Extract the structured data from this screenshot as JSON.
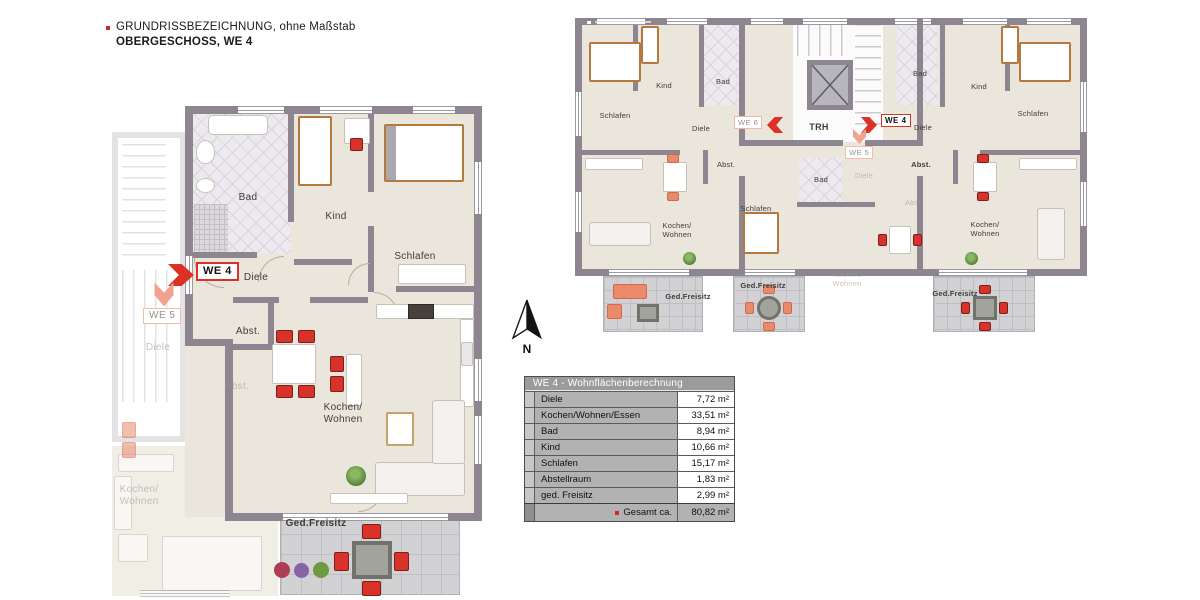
{
  "legend": {
    "line1": "GRUNDRISSBEZEICHNUNG, ohne Maßstab",
    "line2": "OBERGESCHOSS, WE 4"
  },
  "compass": {
    "north_label": "N"
  },
  "detail_plan": {
    "badges": {
      "we4": "WE 4",
      "we5": "WE 5"
    },
    "rooms": {
      "bad": "Bad",
      "kind": "Kind",
      "schlafen": "Schlafen",
      "diele": "Diele",
      "abst_top": "Abst.",
      "abst_bottom": "Abst.",
      "kochen_wohnen": "Kochen/\nWohnen",
      "ged_freisitz": "Ged.Freisitz"
    },
    "neighbor": {
      "diele": "Diele",
      "kochen_wohnen": "Kochen/\nWohnen"
    }
  },
  "overview_plan": {
    "stairwell_label": "TRH",
    "badges": {
      "we6": "WE 6",
      "we4": "WE 4",
      "we5": "WE 5"
    },
    "we6": {
      "schlafen": "Schlafen",
      "kind": "Kind",
      "bad": "Bad",
      "diele": "Diele",
      "abst": "Abst.",
      "kochen_wohnen": "Kochen/\nWohnen",
      "ged_freisitz": "Ged.Freisitz"
    },
    "we5": {
      "bad": "Bad",
      "diele": "Diele",
      "schlafen": "Schlafen",
      "abst": "Abst.",
      "kochen_wohnen": "Kochen/\nWohnen",
      "ged_freisitz": "Ged.Freisitz"
    },
    "we4": {
      "bad": "Bad",
      "kind": "Kind",
      "schlafen": "Schlafen",
      "diele": "Diele",
      "abst": "Abst.",
      "kochen_wohnen": "Kochen/\nWohnen",
      "ged_freisitz": "Ged.Freisitz"
    }
  },
  "area_table": {
    "title": "WE 4 - Wohnflächenberechnung",
    "rows": [
      {
        "label": "Diele",
        "value": "7,72 m²"
      },
      {
        "label": "Kochen/Wohnen/Essen",
        "value": "33,51 m²"
      },
      {
        "label": "Bad",
        "value": "8,94 m²"
      },
      {
        "label": "Kind",
        "value": "10,66 m²"
      },
      {
        "label": "Schlafen",
        "value": "15,17 m²"
      },
      {
        "label": "Abstellraum",
        "value": "1,83 m²"
      },
      {
        "label": "ged. Freisitz",
        "value": "2,99 m²"
      }
    ],
    "total_label": "Gesamt ca.",
    "total_value": "80,82 m²"
  },
  "colors": {
    "wall": "#8D8590",
    "floor": "#EAE6DB",
    "accent_red": "#DC3127",
    "accent_salmon": "#F2A38F",
    "terrace_tile": "#D2D2D5",
    "table_header_bg": "#9B9B9B",
    "table_label_bg": "#B2B2B2"
  }
}
